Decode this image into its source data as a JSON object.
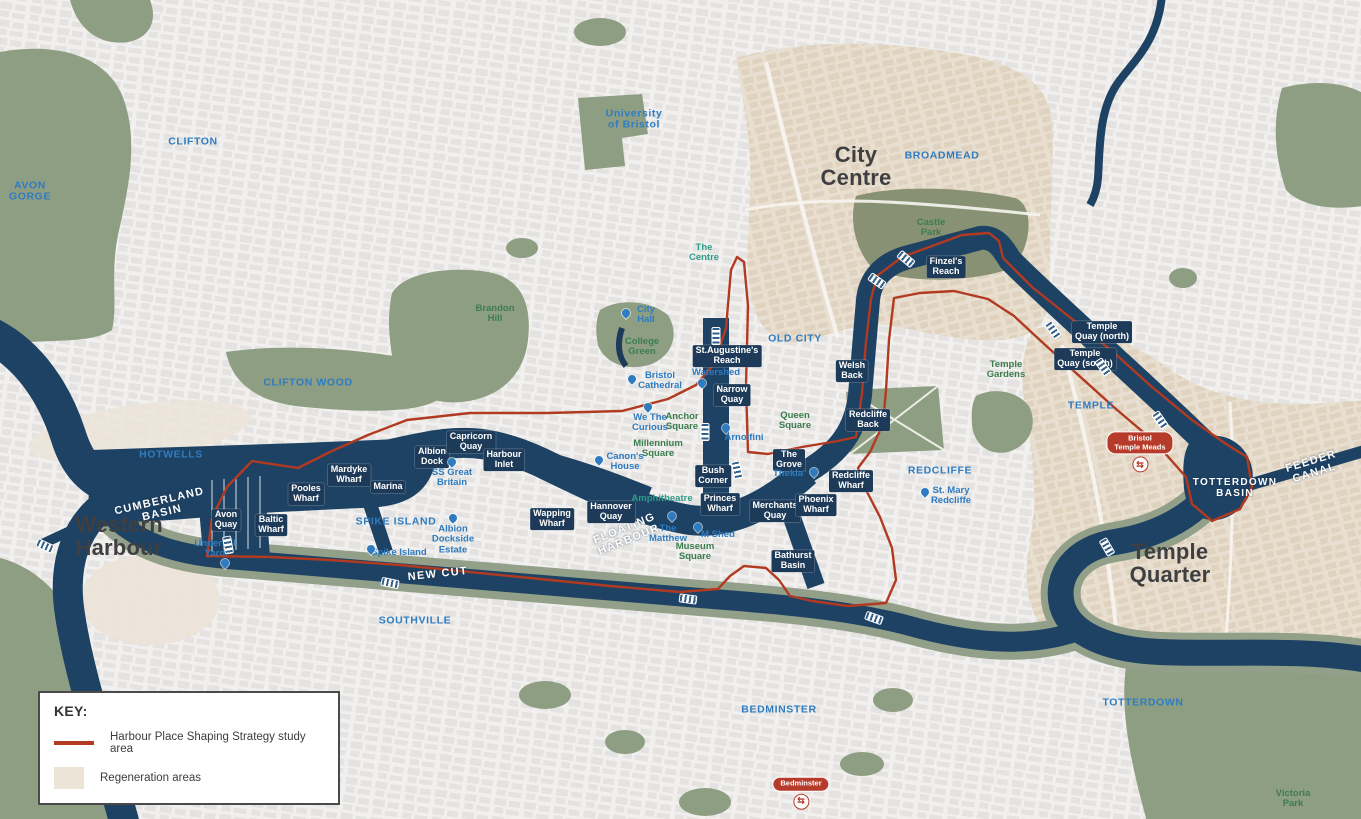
{
  "legend": {
    "title": "KEY:",
    "items": [
      {
        "type": "line",
        "label": "Harbour Place Shaping Strategy study area"
      },
      {
        "type": "area",
        "label": "Regeneration areas"
      }
    ]
  },
  "colors": {
    "water": "#1e4264",
    "park": "#8e9e83",
    "castle": "#889173",
    "regen": "#e9dfd0",
    "regen_west": "#ece3d8",
    "halo": "#93a089",
    "study": "#b23a21",
    "district_blue": "#2f7cc0",
    "poi_blue": "#2e7bc0",
    "green_label": "#3c7d4e",
    "teal": "#2f9c8a",
    "area_dark": "#3f3f41",
    "pill": "#1d3a58",
    "station_red": "#b63b2a"
  },
  "map": {
    "areas": [
      {
        "text": "Western\nHarbour",
        "x": 119,
        "y": 536
      },
      {
        "text": "City\nCentre",
        "x": 856,
        "y": 166
      },
      {
        "text": "Temple\nQuarter",
        "x": 1170,
        "y": 563
      }
    ],
    "districts": [
      {
        "text": "CLIFTON",
        "x": 193,
        "y": 142
      },
      {
        "text": "AVON\nGORGE",
        "x": 30,
        "y": 192
      },
      {
        "text": "HOTWELLS",
        "x": 171,
        "y": 455
      },
      {
        "text": "CLIFTON WOOD",
        "x": 308,
        "y": 383
      },
      {
        "text": "SPIKE ISLAND",
        "x": 396,
        "y": 522
      },
      {
        "text": "SOUTHVILLE",
        "x": 415,
        "y": 621
      },
      {
        "text": "BEDMINSTER",
        "x": 779,
        "y": 710
      },
      {
        "text": "TOTTERDOWN",
        "x": 1143,
        "y": 703
      },
      {
        "text": "REDCLIFFE",
        "x": 940,
        "y": 471
      },
      {
        "text": "OLD CITY",
        "x": 795,
        "y": 339
      },
      {
        "text": "TEMPLE",
        "x": 1091,
        "y": 406
      },
      {
        "text": "BROADMEAD",
        "x": 942,
        "y": 156
      },
      {
        "text": "University\nof Bristol",
        "x": 634,
        "y": 120
      }
    ],
    "water_labels": [
      {
        "text": "CUMBERLAND\nBASIN",
        "x": 161,
        "y": 508,
        "rot": -13
      },
      {
        "text": "FLOATING\nHARBOUR",
        "x": 627,
        "y": 535,
        "rot": -22
      },
      {
        "text": "NEW CUT",
        "x": 438,
        "y": 575,
        "rot": -6
      },
      {
        "text": "FEEDER CANAL",
        "x": 1313,
        "y": 468,
        "rot": -17
      },
      {
        "text": "TOTTERDOWN\nBASIN",
        "x": 1235,
        "y": 489,
        "size": 10
      }
    ],
    "wharves": [
      {
        "text": "Avon\nQuay",
        "x": 226,
        "y": 520
      },
      {
        "text": "Baltic\nWharf",
        "x": 271,
        "y": 525
      },
      {
        "text": "Pooles\nWharf",
        "x": 306,
        "y": 494
      },
      {
        "text": "Mardyke\nWharf",
        "x": 349,
        "y": 475
      },
      {
        "text": "Marina",
        "x": 388,
        "y": 487
      },
      {
        "text": "Albion\nDock",
        "x": 432,
        "y": 457
      },
      {
        "text": "Capricorn\nQuay",
        "x": 471,
        "y": 442
      },
      {
        "text": "Harbour\nInlet",
        "x": 504,
        "y": 460
      },
      {
        "text": "Wapping\nWharf",
        "x": 552,
        "y": 519
      },
      {
        "text": "Hannover\nQuay",
        "x": 611,
        "y": 512
      },
      {
        "text": "St.Augustine's\nReach",
        "x": 727,
        "y": 356
      },
      {
        "text": "Narrow\nQuay",
        "x": 732,
        "y": 395
      },
      {
        "text": "Bush\nCorner",
        "x": 713,
        "y": 476
      },
      {
        "text": "Princes\nWharf",
        "x": 720,
        "y": 504
      },
      {
        "text": "Merchants\nQuay",
        "x": 775,
        "y": 511
      },
      {
        "text": "Phoenix\nWharf",
        "x": 816,
        "y": 505
      },
      {
        "text": "Bathurst\nBasin",
        "x": 793,
        "y": 561
      },
      {
        "text": "The\nGrove",
        "x": 789,
        "y": 460
      },
      {
        "text": "Welsh\nBack",
        "x": 852,
        "y": 371
      },
      {
        "text": "Redcliffe\nBack",
        "x": 868,
        "y": 420
      },
      {
        "text": "Redcliffe\nWharf",
        "x": 851,
        "y": 481
      },
      {
        "text": "Finzel's\nReach",
        "x": 946,
        "y": 267
      },
      {
        "text": "Temple\nQuay (north)",
        "x": 1102,
        "y": 332
      },
      {
        "text": "Temple\nQuay (south)",
        "x": 1085,
        "y": 359
      }
    ],
    "pois": [
      {
        "text": "City\nHall",
        "x": 646,
        "y": 315,
        "pin": [
          -20,
          2
        ]
      },
      {
        "text": "Bristol\nCathedral",
        "x": 660,
        "y": 381,
        "pin": [
          -28,
          2
        ]
      },
      {
        "text": "We The\nCurious",
        "x": 650,
        "y": 423,
        "pin": [
          -2,
          -12
        ]
      },
      {
        "text": "Watershed",
        "x": 716,
        "y": 373,
        "pin": [
          -14,
          14
        ]
      },
      {
        "text": "Canon's\nHouse",
        "x": 625,
        "y": 462,
        "pin": [
          -26,
          2
        ]
      },
      {
        "text": "Arnolfini",
        "x": 744,
        "y": 438,
        "pin": [
          -18,
          -6
        ]
      },
      {
        "text": "Thekla",
        "x": 788,
        "y": 474,
        "pin": [
          26,
          2
        ]
      },
      {
        "text": "The\nMatthew",
        "x": 668,
        "y": 534,
        "pin": [
          4,
          -14
        ]
      },
      {
        "text": "M Shed",
        "x": 718,
        "y": 535,
        "pin": [
          -20,
          -4
        ]
      },
      {
        "text": "St. Mary\nRedcliffe",
        "x": 951,
        "y": 496,
        "pin": [
          -26,
          0
        ]
      },
      {
        "text": "Underfall\nYard",
        "x": 215,
        "y": 549,
        "pin": [
          10,
          18
        ]
      },
      {
        "text": "SS Great\nBritain",
        "x": 452,
        "y": 478,
        "pin": [
          0,
          -12
        ]
      },
      {
        "text": "Albion\nDockside\nEstate",
        "x": 453,
        "y": 540,
        "pin": [
          0,
          -18
        ]
      },
      {
        "text": "Spike Island",
        "x": 399,
        "y": 553,
        "pin": [
          -28,
          0
        ]
      }
    ],
    "greens": [
      {
        "text": "College\nGreen",
        "x": 642,
        "y": 347
      },
      {
        "text": "Brandon\nHill",
        "x": 495,
        "y": 314
      },
      {
        "text": "Anchor\nSquare",
        "x": 682,
        "y": 422
      },
      {
        "text": "Millennium\nSquare",
        "x": 658,
        "y": 449
      },
      {
        "text": "Queen\nSquare",
        "x": 795,
        "y": 421
      },
      {
        "text": "Castle\nPark",
        "x": 931,
        "y": 228
      },
      {
        "text": "Temple\nGardens",
        "x": 1006,
        "y": 370
      },
      {
        "text": "Museum\nSquare",
        "x": 695,
        "y": 552
      },
      {
        "text": "Victoria\nPark",
        "x": 1293,
        "y": 799
      },
      {
        "text": "The\nCentre",
        "x": 704,
        "y": 253,
        "teal": true
      },
      {
        "text": "Amphitheatre",
        "x": 662,
        "y": 499,
        "teal": true
      }
    ],
    "stations": [
      {
        "name": "Bristol\nTemple Meads",
        "x": 1140,
        "y": 452
      },
      {
        "name": "Bedminster",
        "x": 801,
        "y": 793
      }
    ],
    "bridges": [
      {
        "x": 45,
        "y": 546,
        "rot": 25
      },
      {
        "x": 228,
        "y": 545,
        "rot": 80
      },
      {
        "x": 390,
        "y": 583,
        "rot": 12
      },
      {
        "x": 688,
        "y": 599,
        "rot": 8
      },
      {
        "x": 874,
        "y": 618,
        "rot": 20
      },
      {
        "x": 737,
        "y": 470,
        "rot": 78
      },
      {
        "x": 705,
        "y": 432,
        "rot": 90
      },
      {
        "x": 716,
        "y": 336,
        "rot": 90
      },
      {
        "x": 877,
        "y": 281,
        "rot": 35
      },
      {
        "x": 906,
        "y": 259,
        "rot": 40
      },
      {
        "x": 1053,
        "y": 330,
        "rot": 55
      },
      {
        "x": 1103,
        "y": 367,
        "rot": 55
      },
      {
        "x": 1160,
        "y": 420,
        "rot": 55
      },
      {
        "x": 1107,
        "y": 547,
        "rot": 60
      }
    ]
  }
}
